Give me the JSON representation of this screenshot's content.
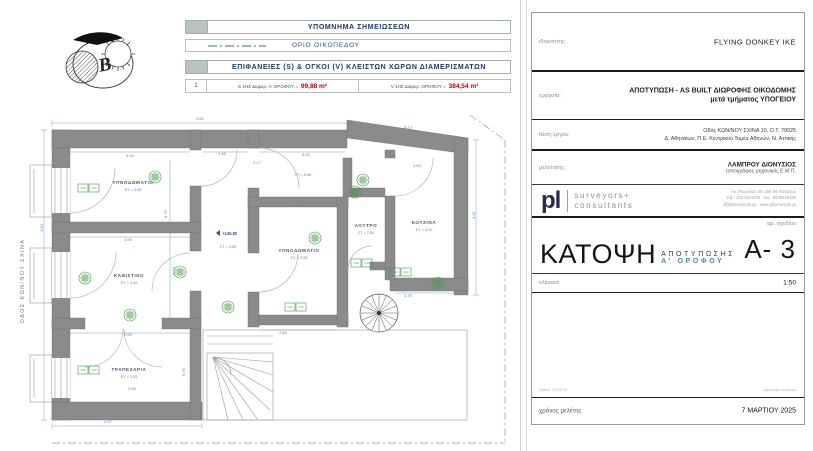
{
  "legend": {
    "notes_header": "ΥΠΟΜΝΗΜΑ  ΣΗΜΕΙΩΣΕΩΝ",
    "plot_boundary_label": "ΟΡΙΟ ΟΙΚΟΠΕΔΟΥ",
    "areas_header": "ΕΠΙΦΑΝΕΙΕΣ (S) & ΟΓΚΟΙ (V) ΚΛΕΙΣΤΩΝ ΧΩΡΩΝ ΔΙΑΜΕΡΙΣΜΑΤΩΝ",
    "row_index": "1",
    "s_label": "S 1ΗΣ Διαμερ. Α' ΟΡΟΦΟΥ =",
    "s_value": "99,88 m²",
    "v_label": "V 1ΗΣ Διαμερ. ΟΡΟΦΟΥ =",
    "v_value": "384,54 m³"
  },
  "north_letter": "B",
  "street_label": "ΟΔΟΣ ΚΩΝ/ΝΟΥ ΣΧΙΝΑ",
  "plan": {
    "level_marker": {
      "t": "+135.80",
      "x": 222,
      "y": 235
    },
    "rooms": [
      {
        "n": "ΥΠΝΟΔΩΜΑΤΙΟ",
        "s": "ΕΥ = 3.05",
        "x": 133,
        "y": 184
      },
      {
        "n": "ΚΑΘΙΣΤΙΚΟ",
        "s": "ΕΥ = 3.05",
        "x": 129,
        "y": 277
      },
      {
        "n": "ΤΡΑΠΕΖΑΡΙΑ",
        "s": "ΕΥ = 3.05",
        "x": 129,
        "y": 371
      },
      {
        "n": "ΥΠΝΟΔΩΜΑΤΙΟ",
        "s": "ΕΥ = 3.05",
        "x": 299,
        "y": 252
      },
      {
        "n": "ΛΟΥΤΡΟ",
        "s": "ΣΤ = 2.50",
        "x": 366,
        "y": 227
      },
      {
        "n": "ΚΟΥΖΙΝΑ",
        "s": "ΕΥ = 3.20",
        "x": 424,
        "y": 224
      },
      {
        "n": "",
        "s": "ΣΤ = 3.50",
        "x": 303,
        "y": 176
      },
      {
        "n": "",
        "s": "ΣΤ = 3.05",
        "x": 228,
        "y": 248
      }
    ],
    "dimensions": [
      {
        "t": "9.61",
        "x": 200,
        "y": 120,
        "r": 0
      },
      {
        "t": "0.75",
        "x": 351,
        "y": 125,
        "r": -70
      },
      {
        "t": "6.17",
        "x": 408,
        "y": 129,
        "r": 8
      },
      {
        "t": "3.94",
        "x": 130,
        "y": 157,
        "r": 0
      },
      {
        "t": "1.40",
        "x": 222,
        "y": 155,
        "r": 0
      },
      {
        "t": "3.32",
        "x": 306,
        "y": 156,
        "r": 0
      },
      {
        "t": "3.17",
        "x": 257,
        "y": 164,
        "r": 0
      },
      {
        "t": "3.60",
        "x": 417,
        "y": 167,
        "r": 0
      },
      {
        "t": "2.98",
        "x": 296,
        "y": 207,
        "r": 0
      },
      {
        "t": "3.95",
        "x": 128,
        "y": 241,
        "r": 0
      },
      {
        "t": "2.90",
        "x": 128,
        "y": 336,
        "r": 0
      },
      {
        "t": "8.75",
        "x": 167,
        "y": 214,
        "r": -90
      },
      {
        "t": "4.73",
        "x": 175,
        "y": 271,
        "r": -90
      },
      {
        "t": "6.75",
        "x": 185,
        "y": 372,
        "r": -90
      },
      {
        "t": "4.41",
        "x": 475,
        "y": 215,
        "r": -90
      },
      {
        "t": "1.90",
        "x": 43,
        "y": 228,
        "r": -90
      },
      {
        "t": "3.96",
        "x": 132,
        "y": 390,
        "r": 0
      },
      {
        "t": "4.97",
        "x": 108,
        "y": 423,
        "r": 0
      },
      {
        "t": "2.80",
        "x": 283,
        "y": 334,
        "r": 0
      },
      {
        "t": "3.75",
        "x": 408,
        "y": 297,
        "r": 0
      }
    ],
    "markers": [
      [
        155,
        177
      ],
      [
        85,
        278
      ],
      [
        180,
        272
      ],
      [
        130,
        315
      ],
      [
        228,
        307
      ],
      [
        315,
        238
      ],
      [
        363,
        180
      ],
      [
        355,
        192
      ],
      [
        438,
        283
      ]
    ],
    "tags": [
      [
        88,
        188
      ],
      [
        88,
        370
      ],
      [
        295,
        307
      ],
      [
        361,
        263
      ],
      [
        400,
        272
      ]
    ],
    "tag_values": {
      "a": "0.90",
      "b": "2.20"
    }
  },
  "titleblock": {
    "owner_label": "ιδιοκτήτης:",
    "owner": "FLYING DONKEY IKE",
    "work_label": "εργασία:",
    "work_line1": "ΑΠΟΤΥΠΩΣΗ - AS BUILT ΔΙΩΡΟΦΗΣ ΟΙΚΟΔΟΜΗΣ",
    "work_line2": "μετά τμήματος ΥΠΟΓΕΙΟΥ",
    "location_label": "θέση έργου:",
    "location_line1": "Οδός ΚΩΝ/ΝΟΥ ΣΧΙΝΑ 10, Ο.Τ. 79025",
    "location_line2": "Δ. Αθηναίων, Π.Ε. Κεντρικού Τομέα Αθηνών, Ν. Αττικής",
    "designer_label": "μελετητής:",
    "designer_line1": "ΛΑΜΠΡΟΥ ΔΙΟΝΥΣΙΟΣ",
    "designer_line2": "τοπογράφος μηχανικός Ε.Μ.Π.",
    "logo": {
      "mark": "pl",
      "word1": "surveyors+",
      "word2": "consultants",
      "addr1": "Αν. Ρωμυλίας 29, 156 69 Παπάγου",
      "addr2": "τηλ.: 210 6511343 - κιν.: 6936528169",
      "addr3": "d@plsurveyors.gr - www.plsurveyors.gr"
    },
    "drawing_no_label": "αρ. σχεδίου",
    "drawing_no": "A- 3",
    "title_main": "ΚΑΤΟΨΗ",
    "title_sub1": "ΑΠΟΤΥΠΩΣΗΣ",
    "title_sub2": "Α' ΟΡΟΦΟΥ",
    "scale_label": "κλίμακα",
    "scale_value": "1:50",
    "ref_left": "Datum: ΕΓΣΑ '87",
    "ref_right": "υψόμετρα σε μέτρα",
    "date_label": "χρόνος μελέτης",
    "date_value": "7 ΜΑΡΤΙΟΥ 2025"
  }
}
